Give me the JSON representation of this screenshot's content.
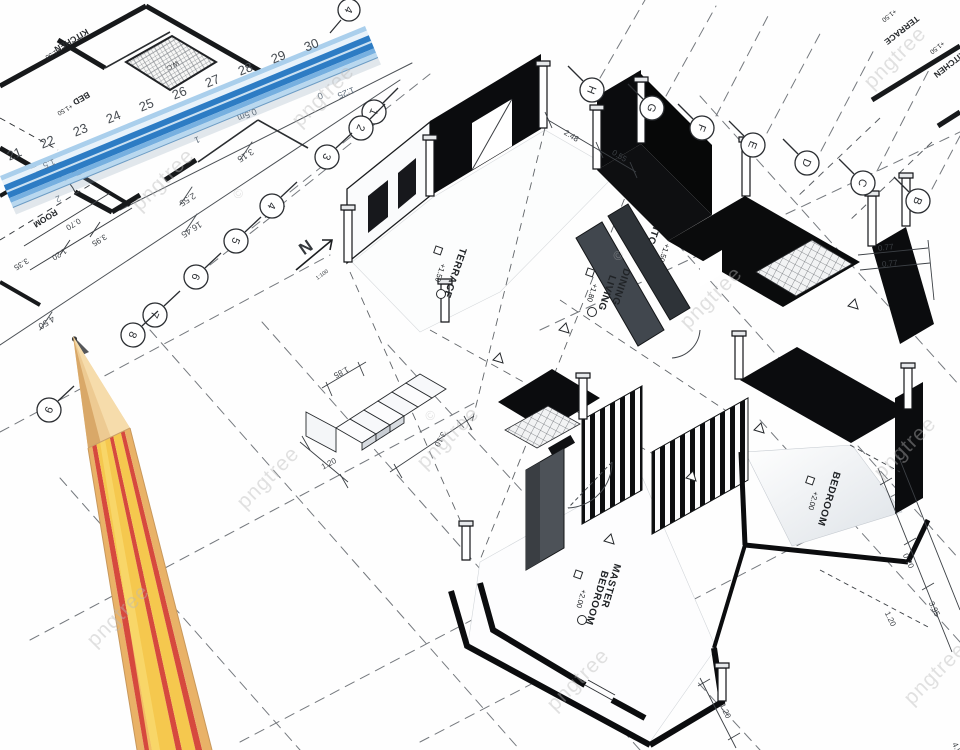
{
  "watermark": {
    "text": "pngtree",
    "copyright": "©"
  },
  "colors": {
    "ruler_blue": "#2d7cc4",
    "pencil_yellow": "#f5c84e",
    "pencil_red": "#d6493e"
  },
  "ruler": {
    "numbers": [
      "21",
      "22",
      "23",
      "24",
      "25",
      "26",
      "27",
      "28",
      "29",
      "30"
    ],
    "half_meter": "0.5m",
    "scale": "1:25",
    "zero": "0",
    "sub_marks": [
      "1.5",
      "1",
      "2"
    ],
    "tip_bubble": "4"
  },
  "grid": {
    "rows": [
      "1",
      "2",
      "3",
      "4",
      "5",
      "6",
      "7",
      "8",
      "9"
    ],
    "cols": [
      "H",
      "G",
      "F",
      "E",
      "D",
      "C",
      "B"
    ]
  },
  "sheet_dims": [
    "4.50",
    "16.45",
    "2.55",
    "3.15"
  ],
  "plan2d": {
    "kitchen": "KITCHEN",
    "kitchen_level": "+1.50",
    "wc": "W.C.",
    "bed": "BED",
    "bed_level": "+1.50",
    "room": "ROOM",
    "room_dims": [
      "0.70",
      "1.20",
      "3.95",
      "3.35"
    ]
  },
  "corner2d": {
    "terrace": "TERRACE",
    "terrace_level": "+1.50",
    "kitchen": "KITCHEN",
    "kitchen_level": "+1.50"
  },
  "north": {
    "letter": "N",
    "scale": "1:100"
  },
  "plan3d": {
    "terrace": {
      "name": "TERRACE",
      "level": "+1.50"
    },
    "kitchen": {
      "name": "KITCHEN",
      "level": "+1.50"
    },
    "dining": {
      "line1": "DINING",
      "line2": "LIVING",
      "level": "+1.80"
    },
    "master": {
      "line1": "MASTER",
      "line2": "BEDROOM",
      "level": "+2.00"
    },
    "bedroom": {
      "name": "BEDROOM",
      "level": "+2.00"
    },
    "dims": {
      "top_a": "2.48",
      "top_b": "0.55",
      "right_a": "0.77",
      "right_b": "0.77",
      "side_a": "0.70",
      "side_b": "1.20",
      "side_c": "3.95",
      "bottom_a": "1.20",
      "bottom_b": "4.50",
      "stairs_a": "1.85",
      "stairs_b": "1.20",
      "stairs_c": "3.10"
    }
  }
}
